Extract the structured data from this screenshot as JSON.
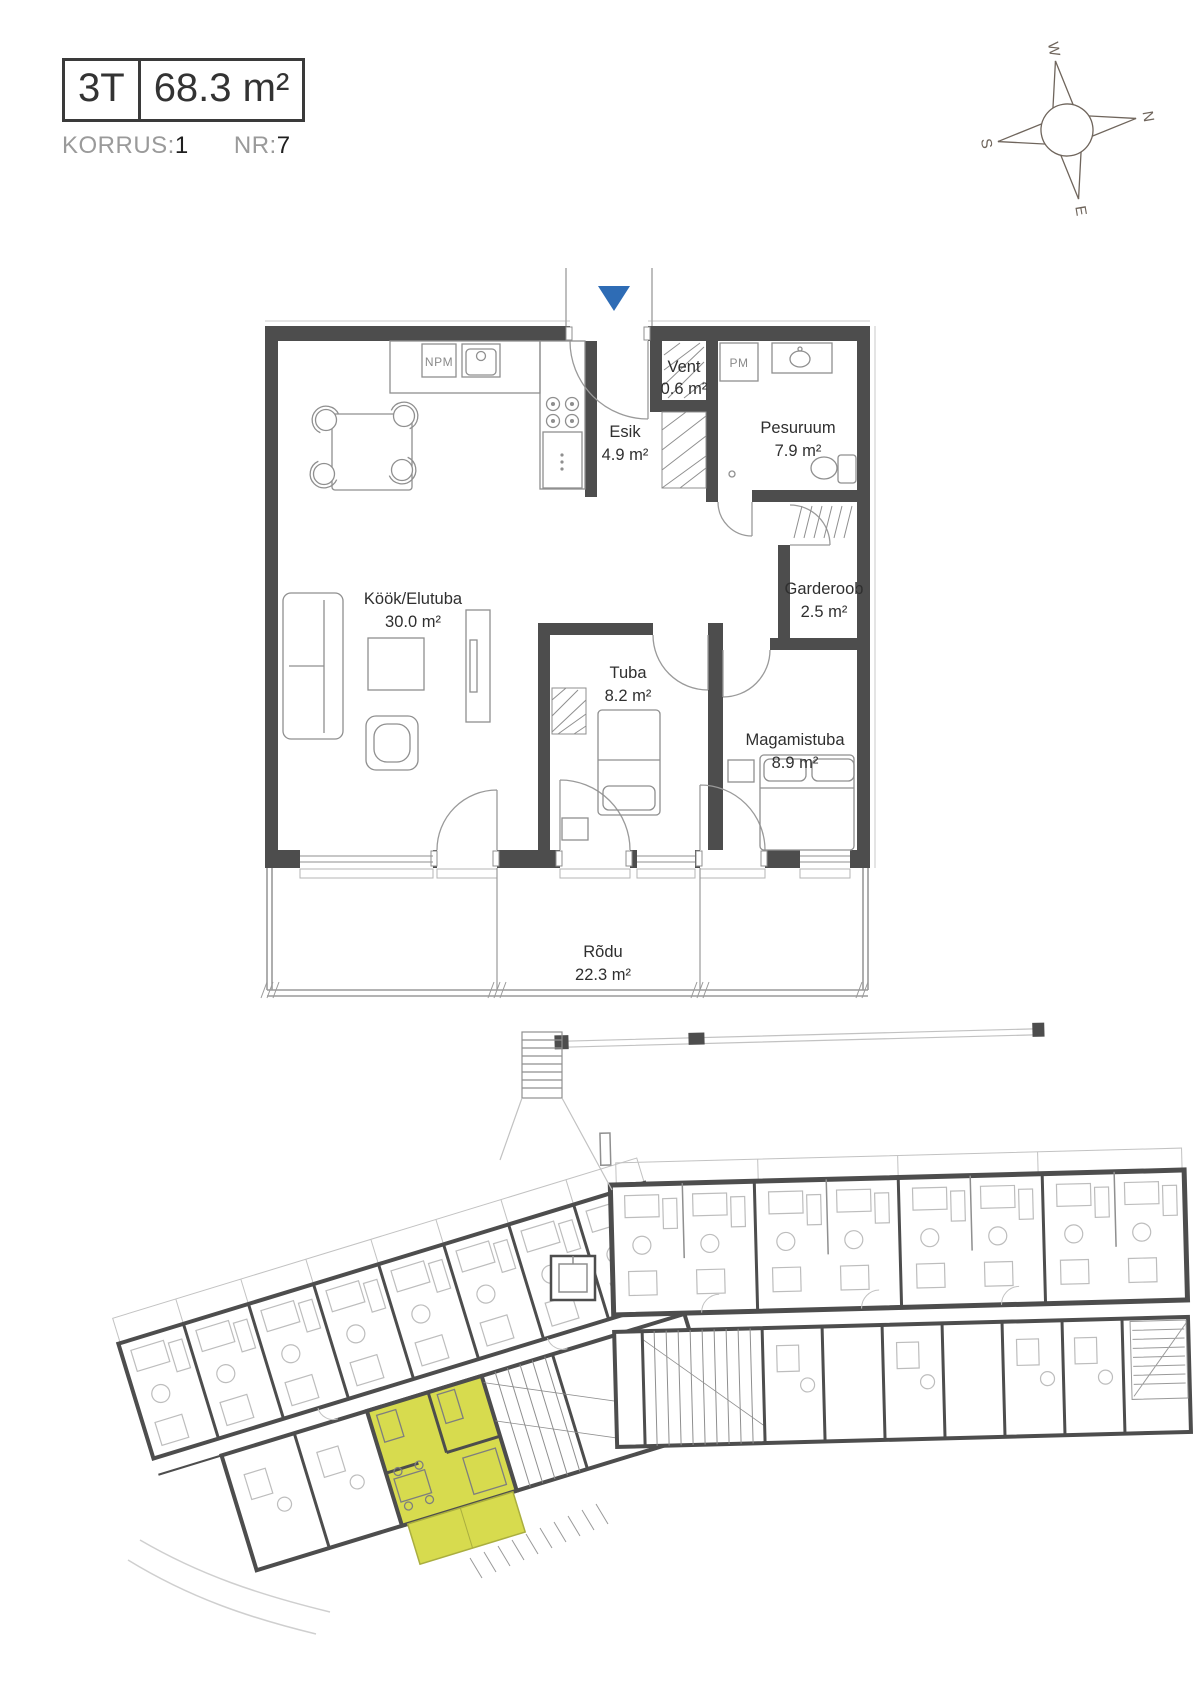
{
  "header": {
    "unit_type": "3T",
    "unit_area": "68.3 m²",
    "floor_label": "KORRUS:",
    "floor_value": "1",
    "number_label": "NR:",
    "number_value": "7"
  },
  "compass": {
    "north": "N",
    "south": "S",
    "east": "E",
    "west": "W"
  },
  "floorplan": {
    "rooms": [
      {
        "name": "Köök/Elutuba",
        "area": "30.0 m²"
      },
      {
        "name": "Esik",
        "area": "4.9 m²"
      },
      {
        "name": "Vent",
        "area": "0.6 m²"
      },
      {
        "name": "Pesuruum",
        "area": "7.9 m²"
      },
      {
        "name": "Garderoob",
        "area": "2.5 m²"
      },
      {
        "name": "Tuba",
        "area": "8.2 m²"
      },
      {
        "name": "Magamistuba",
        "area": "8.9 m²"
      },
      {
        "name": "Rõdu",
        "area": "22.3 m²"
      }
    ],
    "appliances": {
      "dishwasher_label": "NPM",
      "washer_label": "PM"
    }
  },
  "siteplan": {
    "highlight_color": "#d7db4e"
  },
  "colors": {
    "wall": "#4d4d4d",
    "line": "#8f8f8f",
    "light_line": "#c2c2c2",
    "text": "#303030",
    "muted": "#9a9a9a",
    "entrance_arrow": "#2e6cb5"
  }
}
